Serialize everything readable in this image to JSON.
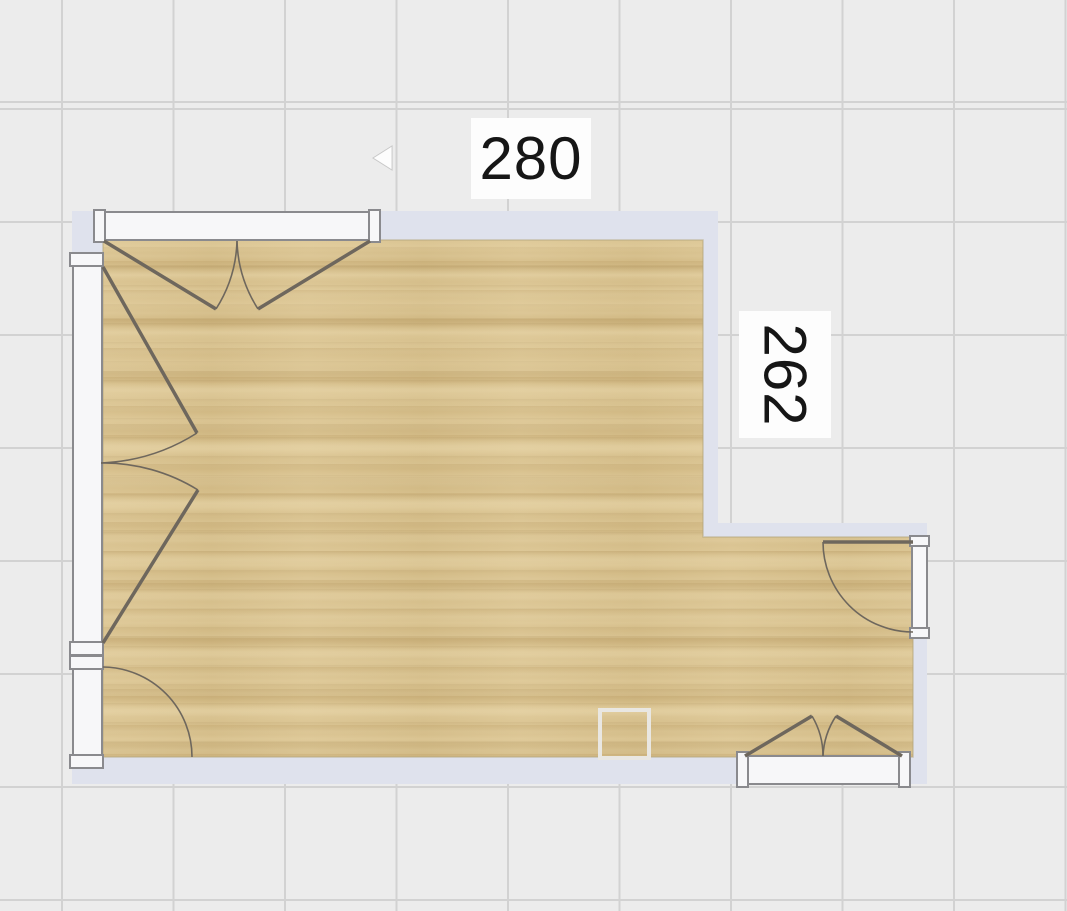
{
  "canvas": {
    "width": 1067,
    "height": 911
  },
  "colors": {
    "background": "#ececec",
    "grid_line": "#d2d2d2",
    "wall": "#dfe2ed",
    "floor_base": "#d7bf8a",
    "floor_outline": "#b2a57b",
    "frame_fill": "#f7f7f9",
    "frame_border": "#8a8a8e",
    "door_line": "#6e675d",
    "column_border": "#e9e7e2",
    "label_bg": "#fdfdfd",
    "label_text": "#161616"
  },
  "dimension_labels": [
    {
      "id": "label-width",
      "text": "280",
      "x": 471,
      "y": 118,
      "w": 120,
      "h": 81,
      "rotated": false
    },
    {
      "id": "label-height",
      "text": "262",
      "x": 739,
      "y": 311,
      "w": 92,
      "h": 127,
      "rotated": true
    }
  ],
  "floorplan": {
    "floor_polygon": [
      [
        103,
        240
      ],
      [
        703,
        240
      ],
      [
        703,
        537
      ],
      [
        913,
        537
      ],
      [
        913,
        757
      ],
      [
        103,
        757
      ]
    ],
    "walls": [
      {
        "name": "wall-top",
        "x": 72,
        "y": 211,
        "w": 646,
        "h": 29
      },
      {
        "name": "wall-left",
        "x": 72,
        "y": 211,
        "w": 31,
        "h": 573
      },
      {
        "name": "wall-bottom",
        "x": 72,
        "y": 757,
        "w": 855,
        "h": 27
      },
      {
        "name": "wall-notch-vertical",
        "x": 703,
        "y": 211,
        "w": 15,
        "h": 326
      },
      {
        "name": "wall-notch-horizontal",
        "x": 703,
        "y": 523,
        "w": 224,
        "h": 14
      },
      {
        "name": "wall-right-lower",
        "x": 913,
        "y": 523,
        "w": 14,
        "h": 261
      }
    ],
    "frames": [
      {
        "name": "french-door-top-frame",
        "rect": [
          94,
          212,
          286,
          28
        ],
        "caps": [
          [
            94,
            210,
            11,
            32
          ],
          [
            369,
            210,
            11,
            32
          ]
        ]
      },
      {
        "name": "double-door-left-frame",
        "rect": [
          73,
          256,
          29,
          399
        ],
        "caps": [
          [
            70,
            253,
            33,
            13
          ],
          [
            70,
            642,
            33,
            13
          ]
        ]
      },
      {
        "name": "window-left-frame",
        "rect": [
          73,
          659,
          29,
          108
        ],
        "caps": [
          [
            70,
            656,
            33,
            13
          ],
          [
            70,
            755,
            33,
            13
          ]
        ]
      },
      {
        "name": "double-door-bottom-frame",
        "rect": [
          737,
          756,
          173,
          28
        ],
        "caps": [
          [
            737,
            752,
            11,
            35
          ],
          [
            899,
            752,
            11,
            35
          ]
        ]
      },
      {
        "name": "door-right-frame",
        "rect": [
          912,
          537,
          15,
          101
        ],
        "caps": [
          [
            910,
            536,
            19,
            10
          ],
          [
            910,
            628,
            19,
            10
          ]
        ]
      }
    ],
    "door_leaves": [
      {
        "name": "french-door-top-left-leaf",
        "x1": 104,
        "y1": 241,
        "x2": 216,
        "y2": 309
      },
      {
        "name": "french-door-top-right-leaf",
        "x1": 370,
        "y1": 241,
        "x2": 258,
        "y2": 309
      },
      {
        "name": "double-door-left-upper-leaf",
        "x1": 103,
        "y1": 267,
        "x2": 197,
        "y2": 433
      },
      {
        "name": "double-door-left-lower-leaf",
        "x1": 103,
        "y1": 643,
        "x2": 198,
        "y2": 490
      },
      {
        "name": "double-door-bottom-left-leaf",
        "x1": 745,
        "y1": 756,
        "x2": 812,
        "y2": 716
      },
      {
        "name": "double-door-bottom-right-leaf",
        "x1": 902,
        "y1": 756,
        "x2": 836,
        "y2": 716
      },
      {
        "name": "door-right-leaf",
        "x1": 913,
        "y1": 542,
        "x2": 823,
        "y2": 542
      }
    ],
    "door_arcs": [
      {
        "name": "french-door-top-left-arc",
        "d": "M216,309 A133,133 0 0 0 237,241"
      },
      {
        "name": "french-door-top-right-arc",
        "d": "M258,309 A133,133 0 0 1 237,241"
      },
      {
        "name": "double-door-left-upper-arc",
        "d": "M197,433 A193,193 0 0 1 101,463"
      },
      {
        "name": "double-door-left-lower-arc",
        "d": "M198,490 A180,180 0 0 0 101,463"
      },
      {
        "name": "window-left-arc",
        "d": "M103,667 A90,90 0 0 1 192,757"
      },
      {
        "name": "double-door-bottom-left-arc",
        "d": "M812,716 A78,78 0 0 1 823,756"
      },
      {
        "name": "double-door-bottom-right-arc",
        "d": "M836,716 A79,79 0 0 0 823,756"
      },
      {
        "name": "door-right-arc",
        "d": "M823,542 A90,90 0 0 0 913,632"
      }
    ],
    "column": {
      "name": "column",
      "x": 600,
      "y": 710,
      "w": 49,
      "h": 48
    },
    "cursor_points": "373,158 392,146 392,170"
  }
}
